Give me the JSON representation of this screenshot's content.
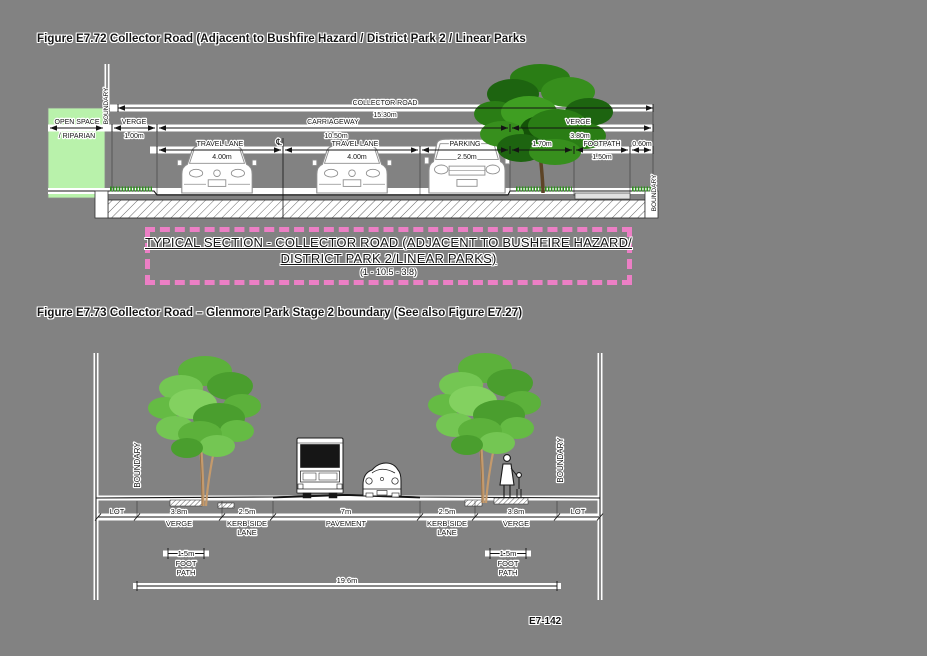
{
  "page": {
    "page_number": "E7-142",
    "background": "#828282"
  },
  "figure1": {
    "title": "Figure E7.72 Collector Road (Adjacent to Bushfire Hazard / District Park 2 / Linear Parks",
    "caption": {
      "line1": "TYPICAL SECTION - COLLECTOR ROAD (ADJACENT TO BUSHFIRE HAZARD/",
      "line2": "DISTRICT PARK 2/LINEAR PARKS)",
      "line3": "(1 - 10.5 - 3.8)",
      "border_color": "#ec7fc5"
    },
    "labels": {
      "boundary_left": "BOUNDARY",
      "boundary_right": "BOUNDARY",
      "open_space_1": "OPEN SPACE",
      "open_space_2": "/ RIPARIAN",
      "collector_road": "COLLECTOR ROAD",
      "collector_road_dim": "15.30m",
      "verge_left": "VERGE",
      "verge_left_dim": "1.00m",
      "carriageway": "CARRIAGEWAY",
      "carriageway_dim": "10.50m",
      "verge_right": "VERGE",
      "verge_right_dim": "3.80m",
      "travel_lane_1": "TRAVEL LANE",
      "travel_lane_1_dim": "4.00m",
      "centerline_symbol": "℄",
      "travel_lane_2": "TRAVEL LANE",
      "travel_lane_2_dim": "4.00m",
      "parking": "PARKING",
      "parking_dim": "2.50m",
      "offset_dim": "1.70m",
      "footpath": "FOOTPATH",
      "footpath_dim": "1.50m",
      "edge_dim": "0.60m"
    },
    "colors": {
      "open_space_fill": "#b9f2ab",
      "tree_foliage": "#2a7d15",
      "grass": "#2f8f1f"
    }
  },
  "figure2": {
    "title": "Figure E7.73 Collector Road – Glenmore Park Stage 2 boundary (See also Figure E7.27)",
    "labels": {
      "boundary_left": "BOUNDARY",
      "boundary_right": "BOUNDARY",
      "lot_left": "LOT",
      "lot_right": "LOT",
      "verge_left_dim": "3.8m",
      "verge_left": "VERGE",
      "kerb_left_dim": "2.5m",
      "kerb_left_1": "KERB SIDE",
      "kerb_left_2": "LANE",
      "pavement_dim": "7m",
      "pavement": "PAVEMENT",
      "kerb_right_dim": "2.5m",
      "kerb_right_1": "KERB SIDE",
      "kerb_right_2": "LANE",
      "verge_right_dim": "3.8m",
      "verge_right": "VERGE",
      "footpath_left_dim": "1.5m",
      "footpath_left_1": "FOOT",
      "footpath_left_2": "PATH",
      "footpath_right_dim": "1.5m",
      "footpath_right_1": "FOOT",
      "footpath_right_2": "PATH",
      "overall_dim": "19.6m"
    },
    "colors": {
      "tree_foliage": "#5cb13b",
      "trunk": "#c49a6c"
    }
  }
}
